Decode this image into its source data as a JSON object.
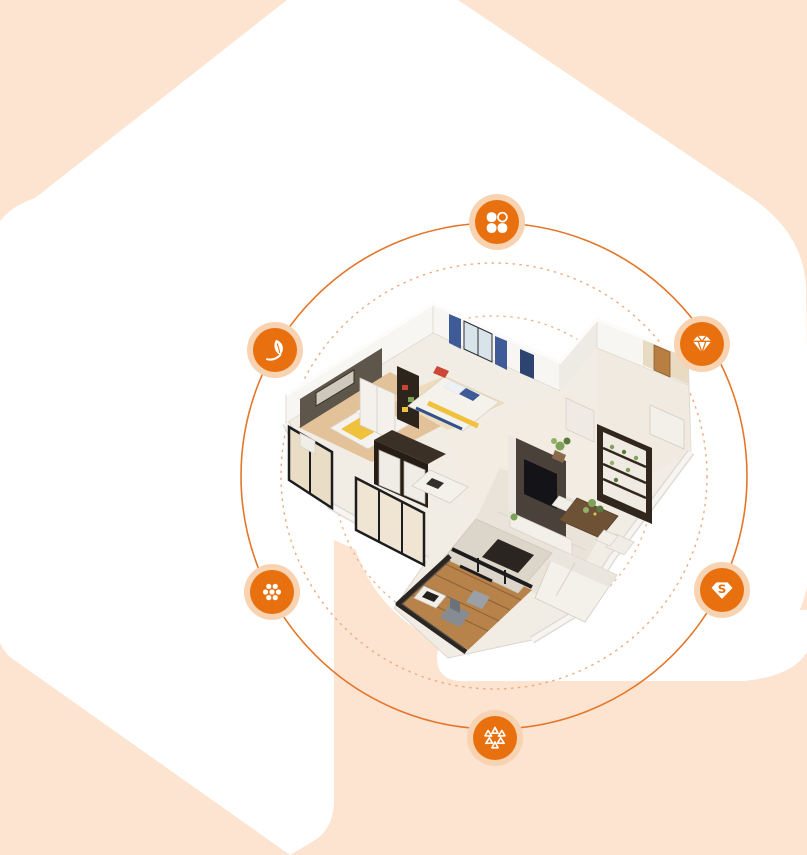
{
  "page": {
    "background_color": "#ffffff"
  },
  "background": {
    "shape_color": "#fce4d1",
    "cutout_color": "#ffffff"
  },
  "orbits": {
    "center": {
      "x": 494,
      "y": 476
    },
    "solid_circle": {
      "radius": 253,
      "color": "#e4762a"
    },
    "dashed_outer_circle": {
      "radius": 213,
      "color": "#f0aa7e"
    },
    "dashed_inner_circle": {
      "radius": 160,
      "color": "#f2b68e"
    }
  },
  "badges": {
    "fill_color": "#e8700f",
    "halo_color": "#f7d3b2",
    "glyph_color": "#ffffff",
    "items": [
      {
        "name": "petals",
        "icon": "clover-petals-icon",
        "x": 497,
        "y": 222
      },
      {
        "name": "leaf",
        "icon": "leaf-icon",
        "x": 275,
        "y": 350
      },
      {
        "name": "gem",
        "icon": "diamond-gem-icon",
        "x": 702,
        "y": 344
      },
      {
        "name": "dots",
        "icon": "dot-cluster-icon",
        "x": 272,
        "y": 592
      },
      {
        "name": "s-badge",
        "icon": "s-gem-icon",
        "letter": "S",
        "x": 722,
        "y": 590
      },
      {
        "name": "triangles",
        "icon": "triangle-ring-icon",
        "x": 495,
        "y": 738
      }
    ]
  },
  "centerpiece": {
    "description": "isometric 3D cutaway floor plan of a furnished apartment",
    "disc_color": "#ffffff"
  }
}
